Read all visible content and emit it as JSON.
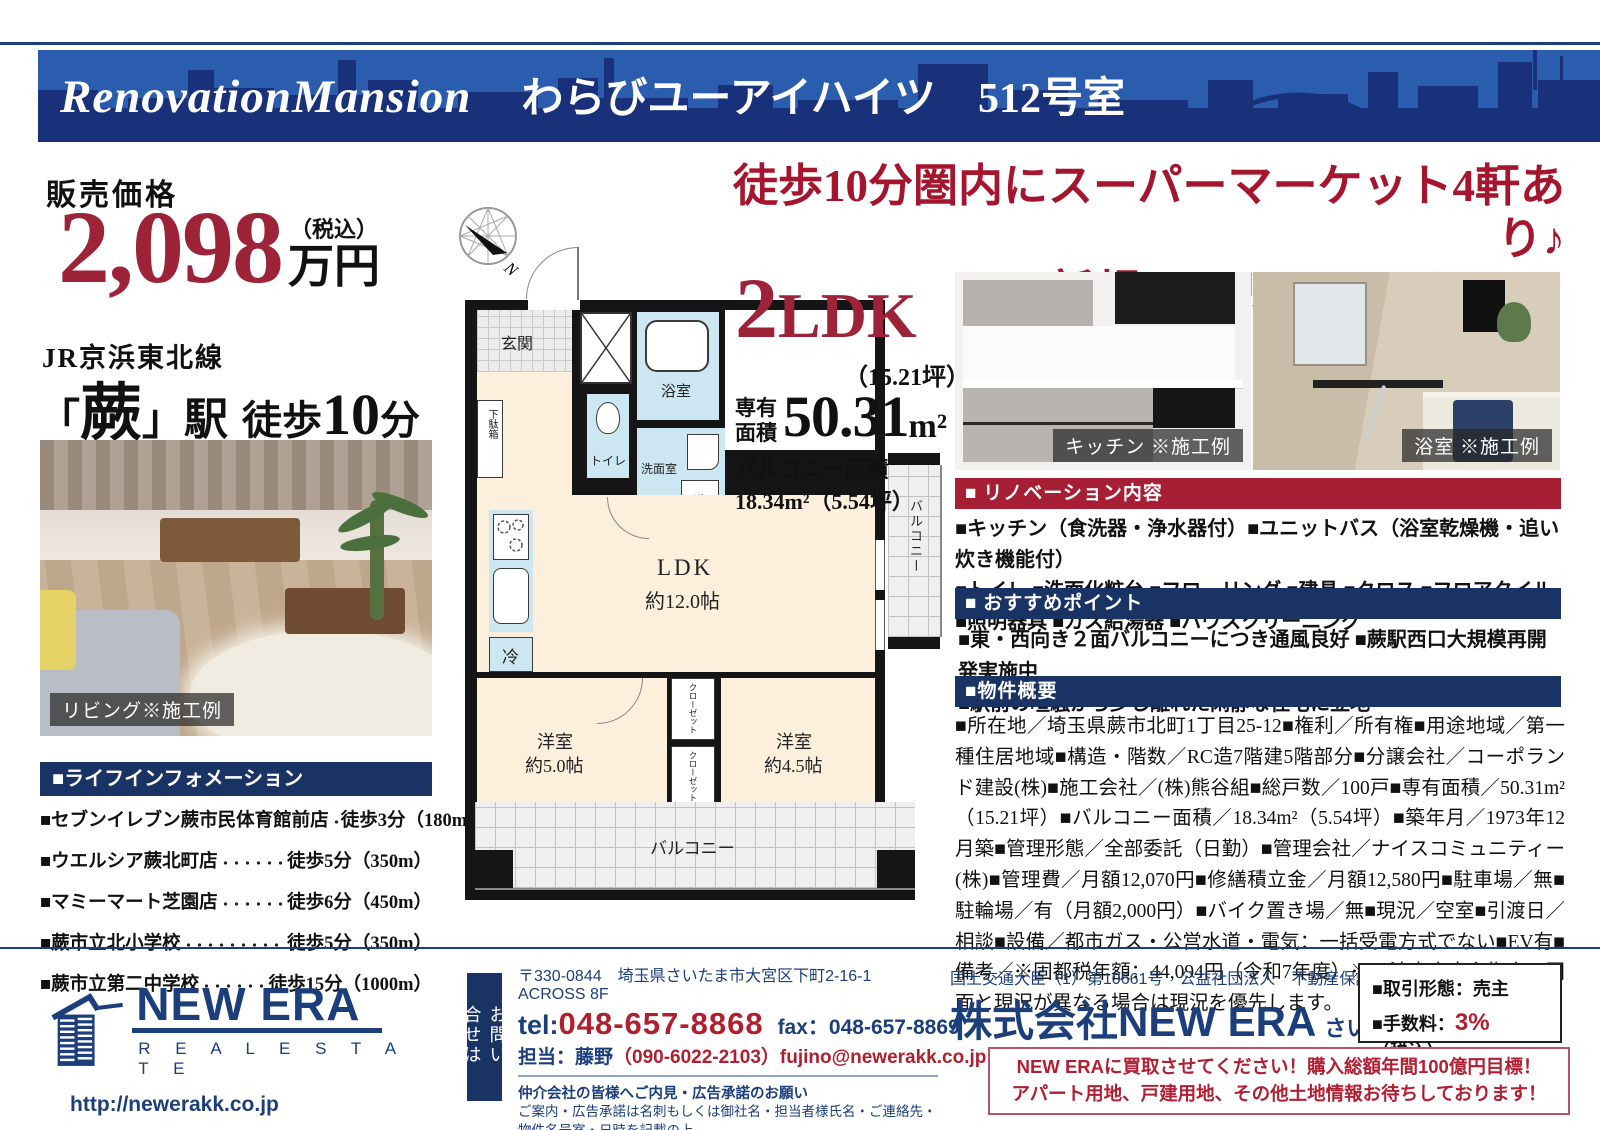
{
  "header": {
    "brand": "RenovationMansion",
    "property_name": "わらびユーアイハイツ",
    "room": "512号室"
  },
  "price": {
    "label": "販売価格",
    "amount": "2,098",
    "tax_note": "（税込）",
    "unit": "万円"
  },
  "access": {
    "line": "JR京浜東北線",
    "bracket_open": "「",
    "station": "蕨",
    "bracket_close": "」",
    "station_suffix": "駅",
    "walk": "徒歩",
    "walk_min": "10",
    "walk_unit": "分"
  },
  "living_photo": {
    "caption": "リビング※施工例"
  },
  "life_info": {
    "title": "■ライフインフォメーション",
    "items": [
      {
        "name": "■セブンイレブン蕨市民体育館前店",
        "value": "徒歩3分（180m）"
      },
      {
        "name": "■ウエルシア蕨北町店",
        "value": "徒歩5分（350m）"
      },
      {
        "name": "■マミーマート芝園店",
        "value": "徒歩6分（450m）"
      },
      {
        "name": "■蕨市立北小学校",
        "value": "徒歩5分（350m）"
      },
      {
        "name": "■蕨市立第二中学校",
        "value": "徒歩15分（1000m）"
      }
    ]
  },
  "headline": {
    "line1": "徒歩10分圏内にスーパーマーケット4軒あり♪",
    "line2": "新規フルリノベーション"
  },
  "plan": {
    "type_big": "2",
    "type_ldk": "LDK",
    "tsubo": "（15.21坪）",
    "area_label_1": "専有",
    "area_label_2": "面積",
    "area_value": "50.31",
    "area_unit": "m²",
    "balcony_label": "バルコニー面積",
    "balcony_value": "18.34m²（5.54坪）",
    "labels": {
      "genkan": "玄関",
      "getabako": "下駄箱",
      "bath": "浴室",
      "toilet": "トイレ",
      "senmen": "洗面室",
      "washer": "洗",
      "ldk1": "LDK",
      "ldk2": "約12.0帖",
      "fridge": "冷",
      "balcony_side": "バルコニー",
      "west_room1": "洋室",
      "west_room1_size": "約5.0帖",
      "west_room2": "洋室",
      "west_room2_size": "約4.5帖",
      "closet_upper": "クローゼット",
      "closet_lower": "クローゼット",
      "balcony_bottom": "バルコニー",
      "north": "N"
    }
  },
  "photos": {
    "kitchen_caption": "キッチン ※施工例",
    "bath_caption": "浴室 ※施工例"
  },
  "renovation": {
    "title": "■ リノベーション内容",
    "lines": [
      "■キッチン（食洗器・浄水器付）■ユニットバス（浴室乾燥機・追い炊き機能付）",
      "■トイレ ■洗面化粧台 ■フローリング ■建具 ■クロス ■フロアタイル",
      "■照明器具 ■ガス給湯器 ■ハウスクリーニング"
    ]
  },
  "points": {
    "title": "■ おすすめポイント",
    "lines": [
      "■東・西向き２面バルコニーにつき通風良好 ■蕨駅西口大規模再開発実施中",
      "■駅前の喧騒から少し離れた閑静な住宅に立地"
    ]
  },
  "outline": {
    "title": "■物件概要",
    "text": "■所在地／埼玉県蕨市北町1丁目25-12■権利／所有権■用途地域／第一種住居地域■構造・階数／RC造7階建5階部分■分譲会社／コーポランド建設(株)■施工会社／(株)熊谷組■総戸数／100戸■専有面積／50.31m²（15.21坪）■バルコニー面積／18.34m²（5.54坪）■築年月／1973年12月築■管理形態／全部委託（日勤）■管理会社／ナイスコミュニティー(株)■管理費／月額12,070円■修繕積立金／月額12,580円■駐車場／無■駐輪場／有（月額2,000円）■バイク置き場／無■現況／空室■引渡日／相談■設備／都市ガス・公営水道・電気：一括受電方式でない■EV有■備考／※固都税年額：44,094円（令和7年度）※司法書士売主指定※図面と現況が異なる場合は現況を優先します。"
  },
  "footer": {
    "address": "〒330-0844　埼玉県さいたま市大宮区下町2-16-1　ACROSS 8F",
    "tel_label": "tel:",
    "tel": "048-657-8868",
    "fax": "fax：048-657-8869",
    "tanto_label": "担当：藤野",
    "tanto_detail": "（090-6022-2103）fujino@newerakk.co.jp",
    "request_title": "仲介会社の皆様へご内見・広告承諾のお願い",
    "request_line1": "ご案内・広告承諾は名刺もしくは御社名・担当者様氏名・ご連絡先・物件名号室・日時を記載の上",
    "request_email": "fujino@newerakk.co.jp",
    "request_line2": "へご連絡お願いします。担当からご返答させて頂きます。",
    "inquiry_vertical": "お問い合せは",
    "license": "国土交通大臣（1）第10661号　公益社団法人　不動産保証協会",
    "company": "株式会社NEW ERA",
    "branch": "さいたま支店",
    "deal_type": "■取引形態：売主",
    "fee_label": "■手数料：",
    "fee_value": "3%",
    "fee_tax": "（税込）",
    "promo_line1": "NEW ERAに買取させてください！購入総額年間100億円目標！",
    "promo_line2": "アパート用地、戸建用地、その他土地情報お待ちしております！",
    "logo_name": "NEW ERA",
    "logo_sub": "R E A L   E S T A T E",
    "logo_url": "http://newerakk.co.jp"
  }
}
